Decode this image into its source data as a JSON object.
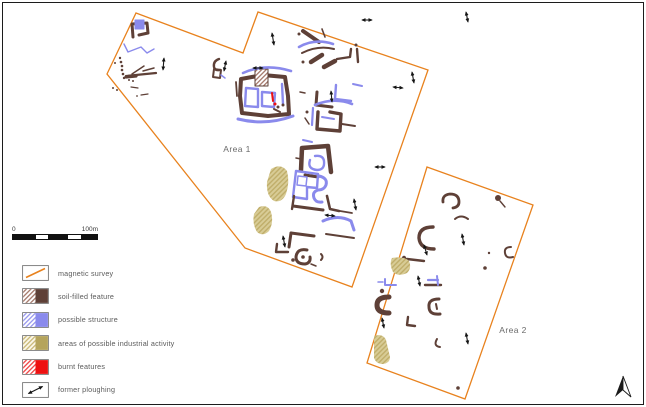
{
  "colors": {
    "survey_orange": "#E8821E",
    "soil": "#5E4037",
    "structure": "#8A8AEC",
    "industrial": "#B5A45C",
    "burnt": "#EE1111",
    "ink": "#1A1A1A",
    "white": "#FFFFFF",
    "label_grey": "#6A6A6A",
    "soilHatch": "url(#h-soil)",
    "tanHatch": "url(#h-tanm)"
  },
  "scalebar": {
    "start_label": "0",
    "end_label": "100m",
    "segments": [
      {
        "pct": 27,
        "filled": true
      },
      {
        "pct": 15,
        "filled": false
      },
      {
        "pct": 24,
        "filled": true
      },
      {
        "pct": 15,
        "filled": false
      },
      {
        "pct": 19,
        "filled": true
      }
    ]
  },
  "legend": {
    "items": [
      {
        "label": "magnetic survey",
        "swatch": "survey"
      },
      {
        "label": "soil-filled feature",
        "swatch": "soil"
      },
      {
        "label": "possible structure",
        "swatch": "structure"
      },
      {
        "label": "areas of possible industrial activity",
        "swatch": "industrial"
      },
      {
        "label": "burnt features",
        "swatch": "burnt"
      },
      {
        "label": "former ploughing",
        "swatch": "plough"
      }
    ]
  },
  "map": {
    "area1": {
      "label": "Area 1",
      "label_x": 237,
      "label_y": 152,
      "points": "136,13 243,53 258,12 428,70 352,287 245,248 107,74"
    },
    "area2": {
      "label": "Area 2",
      "label_x": 513,
      "label_y": 333,
      "points": "427,167 533,205 465,399 367,363"
    },
    "north_arrow_label": "north",
    "features": [
      {
        "d": "M133,37 L132,24 L147,23 L148,33 L139,35",
        "c": "soil",
        "w": 3
      },
      {
        "d": "M135,20 h9 v9 h-9 Z",
        "c": "structure",
        "w": 1,
        "f": "structure"
      },
      {
        "d": "M124,44 L128,52 L141,47 L147,53 L154,49",
        "c": "structure",
        "w": 1.4
      },
      {
        "cx": 115,
        "cy": 63,
        "r": 1,
        "c": "soil"
      },
      {
        "cx": 120,
        "cy": 58,
        "r": 1.2,
        "c": "soil"
      },
      {
        "cx": 121,
        "cy": 62,
        "r": 1.3,
        "c": "soil"
      },
      {
        "cx": 122,
        "cy": 66,
        "r": 1.3,
        "c": "soil"
      },
      {
        "cx": 122,
        "cy": 70,
        "r": 1.3,
        "c": "soil"
      },
      {
        "cx": 123,
        "cy": 74,
        "r": 1.3,
        "c": "soil"
      },
      {
        "cx": 124,
        "cy": 78,
        "r": 1.2,
        "c": "soil"
      },
      {
        "d": "M126,76 L156,73",
        "c": "soil",
        "w": 2.2
      },
      {
        "d": "M126,77 L136,76",
        "c": "soil",
        "w": 3.2
      },
      {
        "d": "M132,74 L144,66",
        "c": "soil",
        "w": 1.5
      },
      {
        "d": "M143,71 L154,68",
        "c": "soil",
        "w": 1.5
      },
      {
        "cx": 129,
        "cy": 80,
        "r": 1,
        "c": "soil"
      },
      {
        "cx": 133,
        "cy": 81,
        "r": 1,
        "c": "soil"
      },
      {
        "d": "M131,87 L138,88",
        "c": "soil",
        "w": 1.2
      },
      {
        "cx": 113,
        "cy": 88,
        "r": 1,
        "c": "soil"
      },
      {
        "cx": 117,
        "cy": 90,
        "r": 1,
        "c": "soil"
      },
      {
        "d": "M141,95 L148,94",
        "c": "soil",
        "w": 1.2
      },
      {
        "cx": 137,
        "cy": 96,
        "r": 0.9,
        "c": "soil"
      },
      {
        "d": "M219,59 Q213,61 214,67 Q215,71 220,70",
        "c": "soil",
        "w": 2.4
      },
      {
        "d": "M214,69 l7,1 l-1,8 l-7,-1 Z",
        "c": "soil",
        "w": 2
      },
      {
        "d": "M221,75 l4,3",
        "c": "structure",
        "w": 1.5
      },
      {
        "d": "M241,79 L240,96 L242,113 L268,116 L289,114 L288,96 L285,77 L263,75 Z",
        "c": "soil",
        "w": 4
      },
      {
        "d": "M255,69 h13 v17 h-13 Z",
        "c": "soil",
        "w": 1,
        "f": "soilHatch"
      },
      {
        "d": "M243,73 Q265,63 291,71",
        "c": "structure",
        "w": 2.6
      },
      {
        "d": "M238,119 Q266,126 293,116",
        "c": "structure",
        "w": 3
      },
      {
        "d": "M246,88 L245,106 L258,107 L258,89 Z",
        "c": "structure",
        "w": 2.4
      },
      {
        "d": "M262,92 L275,93 L274,107 L262,106 Z",
        "c": "structure",
        "w": 2.4
      },
      {
        "d": "M282,84 L283,104",
        "c": "structure",
        "w": 2.4
      },
      {
        "d": "M272,93 L273,101",
        "c": "burnt",
        "w": 2
      },
      {
        "cx": 275,
        "cy": 104,
        "r": 1.5,
        "c": "burnt"
      },
      {
        "cx": 278,
        "cy": 107,
        "r": 1.5,
        "c": "soil"
      },
      {
        "cx": 283,
        "cy": 105,
        "r": 1.5,
        "c": "soil"
      },
      {
        "d": "M274,109 l6,3",
        "c": "soil",
        "w": 2
      },
      {
        "d": "M236,82 L237,96",
        "c": "soil",
        "w": 1.8
      },
      {
        "d": "M303,31 L319,42",
        "c": "soil",
        "w": 4
      },
      {
        "d": "M299,47 Q315,38 333,44",
        "c": "structure",
        "w": 2.6
      },
      {
        "d": "M302,53 Q318,45 334,49",
        "c": "soil",
        "w": 2
      },
      {
        "cx": 299,
        "cy": 34,
        "r": 1.5,
        "c": "soil"
      },
      {
        "d": "M322,29 l3,8",
        "c": "soil",
        "w": 1.6
      },
      {
        "d": "M311,62 l11,-7",
        "c": "soil",
        "w": 4.5
      },
      {
        "d": "M324,67 l11,-6",
        "c": "soil",
        "w": 4.5
      },
      {
        "d": "M337,59 L350,57 L351,49",
        "c": "soil",
        "w": 2.4
      },
      {
        "d": "M357,49 L358,62",
        "c": "soil",
        "w": 2.4
      },
      {
        "cx": 356,
        "cy": 45,
        "r": 1.5,
        "c": "soil"
      },
      {
        "d": "M317,92 L316,105 L332,107",
        "c": "soil",
        "w": 3
      },
      {
        "d": "M336,85 L335,99 L351,101",
        "c": "structure",
        "w": 2.4
      },
      {
        "d": "M353,84 l9,2",
        "c": "structure",
        "w": 2
      },
      {
        "d": "M300,92 l5,1",
        "c": "soil",
        "w": 1.5
      },
      {
        "cx": 303,
        "cy": 62,
        "r": 1.5,
        "c": "soil"
      },
      {
        "d": "M315,105 Q334,97 352,104",
        "c": "structure",
        "w": 2.6
      },
      {
        "d": "M318,112 L317,129 L340,131 L341,114 L330,112",
        "c": "soil",
        "w": 3.4
      },
      {
        "d": "M313,108 L312,125",
        "c": "structure",
        "w": 2.2
      },
      {
        "d": "M322,117 L334,119",
        "c": "structure",
        "w": 2
      },
      {
        "d": "M342,124 L355,126",
        "c": "soil",
        "w": 2
      },
      {
        "cx": 307,
        "cy": 112,
        "r": 1.5,
        "c": "soil"
      },
      {
        "d": "M305,118 l4,6",
        "c": "soil",
        "w": 1.5
      },
      {
        "d": "M301,170 L302,148 L328,146 L331,172",
        "c": "soil",
        "w": 4.5
      },
      {
        "d": "M305,175 L318,177",
        "c": "soil",
        "w": 3
      },
      {
        "d": "M310,160 Q307,169 317,170 Q325,170 324,161 Q323,155 315,156",
        "c": "structure",
        "w": 2.4
      },
      {
        "d": "M303,140 l9,2",
        "c": "structure",
        "w": 2
      },
      {
        "d": "M296,158 l5,1",
        "c": "soil",
        "w": 1.5
      },
      {
        "d": "M296,171 L293,197 L307,199 L307,187 L317,188 L318,174 Z",
        "c": "structure",
        "w": 2.4
      },
      {
        "d": "M298,176 l9,1 l-1,9 l-9,-1 Z",
        "c": "structure",
        "w": 1.5
      },
      {
        "d": "M319,176 Q328,178 326,185 Q324,190 318,190 Q312,192 314,198 Q316,203 322,202",
        "c": "structure",
        "w": 3
      },
      {
        "d": "M294,196 L292,209",
        "c": "soil",
        "w": 2.4
      },
      {
        "d": "M293,206 L323,210",
        "c": "soil",
        "w": 3
      },
      {
        "d": "M327,196 L330,209 L339,211",
        "c": "soil",
        "w": 2.6
      },
      {
        "d": "M340,211 L352,213",
        "c": "soil",
        "w": 1.8
      },
      {
        "d": "M271,169 Q281,163 287,171 Q290,182 286,194 Q282,203 274,201 Q266,196 267,182 Z",
        "f": "tanHatch"
      },
      {
        "d": "M259,207 Q268,204 271,212 Q274,222 269,231 Q263,237 257,232 Q252,224 254,214 Z",
        "f": "tanHatch"
      },
      {
        "d": "M323,221 Q338,214 351,221 L354,230",
        "c": "structure",
        "w": 3
      },
      {
        "d": "M326,234 L354,238",
        "c": "soil",
        "w": 2
      },
      {
        "d": "M291,233 L314,236",
        "c": "soil",
        "w": 3
      },
      {
        "d": "M291,233 L289,247",
        "c": "soil",
        "w": 3
      },
      {
        "d": "M277,244 L276,252 L288,252",
        "c": "soil",
        "w": 2.4
      },
      {
        "d": "M307,250 Q297,248 296,257 Q296,264 305,264 Q311,263 310,257",
        "c": "soil",
        "w": 3
      },
      {
        "cx": 303,
        "cy": 257,
        "r": 1.8,
        "c": "soil"
      },
      {
        "cx": 293,
        "cy": 260,
        "r": 1.8,
        "c": "soil"
      },
      {
        "d": "M311,264 l5,2",
        "c": "soil",
        "w": 1.5
      },
      {
        "d": "M321,254 q3,3 0,6",
        "c": "soil",
        "w": 2
      },
      {
        "d": "M443,202 Q442,195 450,194 Q459,194 459,202 Q459,207 453,208",
        "c": "soil",
        "w": 2.8
      },
      {
        "d": "M455,219 Q461,214 468,219",
        "c": "soil",
        "w": 2
      },
      {
        "d": "M433,227 Q419,227 419,238 Q420,249 434,249",
        "c": "soil",
        "w": 3.4
      },
      {
        "d": "M407,259 L424,261",
        "c": "soil",
        "w": 2.4
      },
      {
        "cx": 404,
        "cy": 258,
        "r": 2.2,
        "c": "soil"
      },
      {
        "cx": 498,
        "cy": 198,
        "r": 3,
        "c": "soil"
      },
      {
        "d": "M500,201 L505,207",
        "c": "soil",
        "w": 1.4
      },
      {
        "d": "M511,247 Q504,247 505,253 Q506,259 513,257",
        "c": "soil",
        "w": 2
      },
      {
        "cx": 489,
        "cy": 253,
        "r": 1.2,
        "c": "soil"
      },
      {
        "cx": 485,
        "cy": 268,
        "r": 1.8,
        "c": "soil"
      },
      {
        "cx": 458,
        "cy": 388,
        "r": 1.8,
        "c": "soil"
      },
      {
        "d": "M385,279 L385,285 L396,285",
        "c": "structure",
        "w": 2
      },
      {
        "d": "M378,282 l5,0",
        "c": "structure",
        "w": 1.5
      },
      {
        "d": "M425,285 L441,285",
        "c": "soil",
        "w": 2.4
      },
      {
        "d": "M428,280 L438,280",
        "c": "structure",
        "w": 2.2
      },
      {
        "d": "M437,276 L438,285",
        "c": "structure",
        "w": 2
      },
      {
        "d": "M389,297 Q377,297 377,305 Q377,313 389,313",
        "c": "soil",
        "w": 5
      },
      {
        "cx": 382,
        "cy": 291,
        "r": 2.2,
        "c": "soil"
      },
      {
        "d": "M439,299 Q428,299 429,307 Q429,315 440,314",
        "c": "soil",
        "w": 3
      },
      {
        "d": "M436,304 l1,5",
        "c": "soil",
        "w": 2
      },
      {
        "d": "M408,317 L407,325 L415,326",
        "c": "soil",
        "w": 2.4
      },
      {
        "d": "M437,339 Q433,346 440,347",
        "c": "soil",
        "w": 2
      },
      {
        "d": "M392,258 Q404,256 409,261 Q412,268 407,273 Q398,277 393,272 Q389,264 392,258 Z",
        "f": "tanHatch"
      },
      {
        "d": "M374,336 Q383,333 386,340 L390,357 Q390,363 383,364 Q376,364 374,358 Z",
        "f": "tanHatch"
      }
    ],
    "arrows": [
      [
        164,
        58,
        163,
        70
      ],
      [
        226,
        61,
        224,
        71
      ],
      [
        272,
        33,
        274,
        45
      ],
      [
        253,
        68,
        263,
        68
      ],
      [
        331,
        91,
        332,
        102
      ],
      [
        393,
        87,
        403,
        88
      ],
      [
        412,
        72,
        414,
        83
      ],
      [
        375,
        167,
        385,
        167
      ],
      [
        354,
        199,
        356,
        210
      ],
      [
        325,
        215,
        335,
        216
      ],
      [
        283,
        236,
        285,
        247
      ],
      [
        362,
        20,
        372,
        20
      ],
      [
        466,
        12,
        468,
        22
      ],
      [
        462,
        234,
        464,
        245
      ],
      [
        424,
        245,
        427,
        255
      ],
      [
        418,
        276,
        420,
        286
      ],
      [
        382,
        318,
        384,
        328
      ],
      [
        466,
        333,
        468,
        344
      ]
    ]
  }
}
